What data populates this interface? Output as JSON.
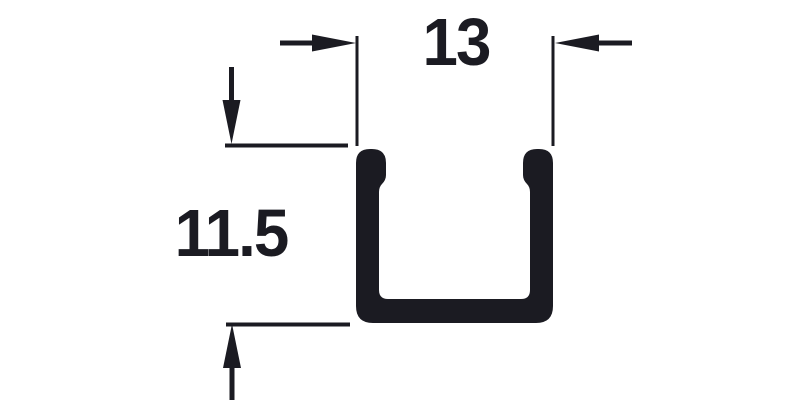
{
  "diagram": {
    "description": "Technical cross-section drawing of a U-channel profile with two dimension callouts",
    "ink_color": "#1b1b22",
    "background_color": "#ffffff",
    "profile": {
      "shape": "u-channel",
      "features": [
        "rounded leg tops",
        "inner retaining lips at top of each leg",
        "rounded outer bottom corners"
      ]
    },
    "dimensions": [
      {
        "id": "width",
        "label": "13",
        "orientation": "horizontal",
        "arrow_style": "outside-pointing-in"
      },
      {
        "id": "height",
        "label": "11.5",
        "orientation": "vertical",
        "arrow_style": "outside-pointing-in"
      }
    ]
  }
}
